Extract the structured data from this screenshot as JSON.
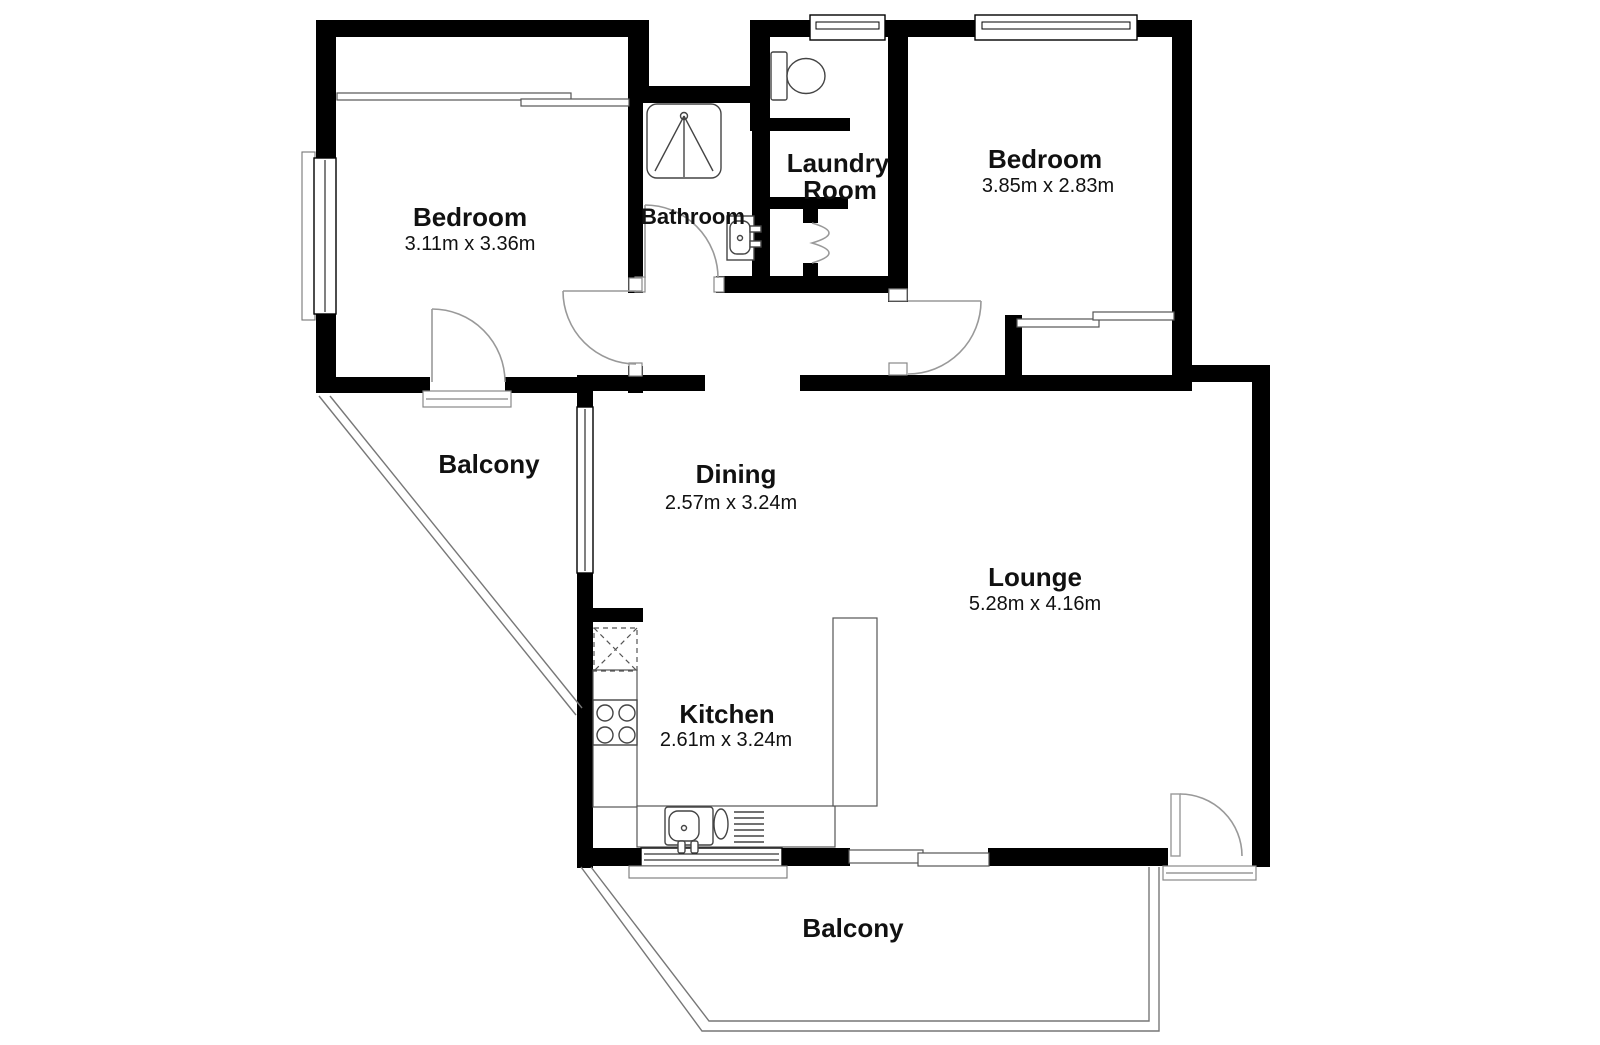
{
  "plan_title": "Apartment floor plan",
  "rooms": {
    "bedroom1": {
      "label": "Bedroom",
      "dimensions": "3.11m x 3.36m"
    },
    "bedroom2": {
      "label": "Bedroom",
      "dimensions": "3.85m x 2.83m"
    },
    "bathroom": {
      "label": "Bathroom"
    },
    "laundry": {
      "label_line1": "Laundry",
      "label_line2": "Room"
    },
    "dining": {
      "label": "Dining",
      "dimensions": "2.57m x 3.24m"
    },
    "lounge": {
      "label": "Lounge",
      "dimensions": "5.28m x 4.16m"
    },
    "kitchen": {
      "label": "Kitchen",
      "dimensions": "2.61m x 3.24m"
    },
    "balcony_top": {
      "label": "Balcony"
    },
    "balcony_bottom": {
      "label": "Balcony"
    }
  },
  "icons": {
    "shower": "shower-stall-icon",
    "toilet": "toilet-icon",
    "basin": "bathroom-sink-icon",
    "stove": "stove-cooktop-icon",
    "kitchen_sink": "kitchen-sink-icon",
    "appliance": "appliance-box-icon"
  },
  "colors": {
    "wall": "#000000",
    "fixture": "#444444",
    "door": "#999999",
    "rail": "#777777",
    "text": "#111111",
    "background": "#ffffff"
  }
}
